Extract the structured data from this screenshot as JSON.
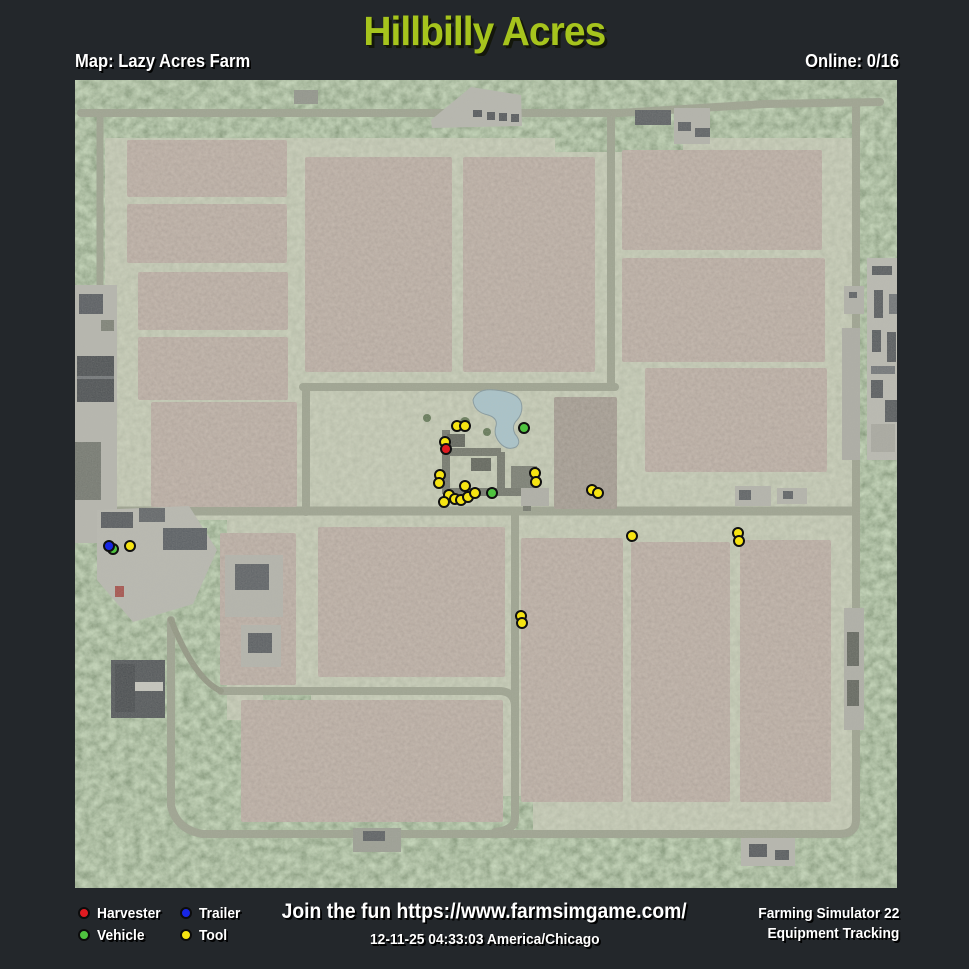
{
  "header": {
    "title": "Hillbilly Acres",
    "map_label": "Map: Lazy Acres Farm",
    "online_label": "Online: 0/16"
  },
  "legend": {
    "items": [
      {
        "id": "harvester",
        "label": "Harvester",
        "color": "#e01b21"
      },
      {
        "id": "trailer",
        "label": "Trailer",
        "color": "#1726e6"
      },
      {
        "id": "vehicle",
        "label": "Vehicle",
        "color": "#4fc33f"
      },
      {
        "id": "tool",
        "label": "Tool",
        "color": "#f6e412"
      }
    ]
  },
  "footer": {
    "promo": "Join the fun https://www.farmsimgame.com/",
    "timestamp": "12-11-25 04:33:03 America/Chicago",
    "brand_line1": "Farming Simulator 22",
    "brand_line2": "Equipment Tracking"
  },
  "map": {
    "markers": [
      {
        "type": "tool",
        "x": 382,
        "y": 346
      },
      {
        "type": "tool",
        "x": 390,
        "y": 346
      },
      {
        "type": "tool",
        "x": 370,
        "y": 362
      },
      {
        "type": "tool",
        "x": 365,
        "y": 395
      },
      {
        "type": "tool",
        "x": 364,
        "y": 403
      },
      {
        "type": "tool",
        "x": 390,
        "y": 406
      },
      {
        "type": "tool",
        "x": 374,
        "y": 415
      },
      {
        "type": "tool",
        "x": 380,
        "y": 419
      },
      {
        "type": "tool",
        "x": 369,
        "y": 422
      },
      {
        "type": "tool",
        "x": 386,
        "y": 420
      },
      {
        "type": "tool",
        "x": 393,
        "y": 417
      },
      {
        "type": "tool",
        "x": 400,
        "y": 413
      },
      {
        "type": "tool",
        "x": 460,
        "y": 393
      },
      {
        "type": "tool",
        "x": 461,
        "y": 402
      },
      {
        "type": "tool",
        "x": 517,
        "y": 410
      },
      {
        "type": "tool",
        "x": 523,
        "y": 413
      },
      {
        "type": "tool",
        "x": 557,
        "y": 456
      },
      {
        "type": "tool",
        "x": 663,
        "y": 453
      },
      {
        "type": "tool",
        "x": 664,
        "y": 461
      },
      {
        "type": "tool",
        "x": 446,
        "y": 536
      },
      {
        "type": "tool",
        "x": 447,
        "y": 543
      },
      {
        "type": "tool",
        "x": 55,
        "y": 466
      },
      {
        "type": "vehicle",
        "x": 449,
        "y": 348
      },
      {
        "type": "vehicle",
        "x": 417,
        "y": 413
      },
      {
        "type": "vehicle",
        "x": 38,
        "y": 469
      },
      {
        "type": "harvester",
        "x": 371,
        "y": 369
      },
      {
        "type": "trailer",
        "x": 34,
        "y": 466
      }
    ]
  }
}
